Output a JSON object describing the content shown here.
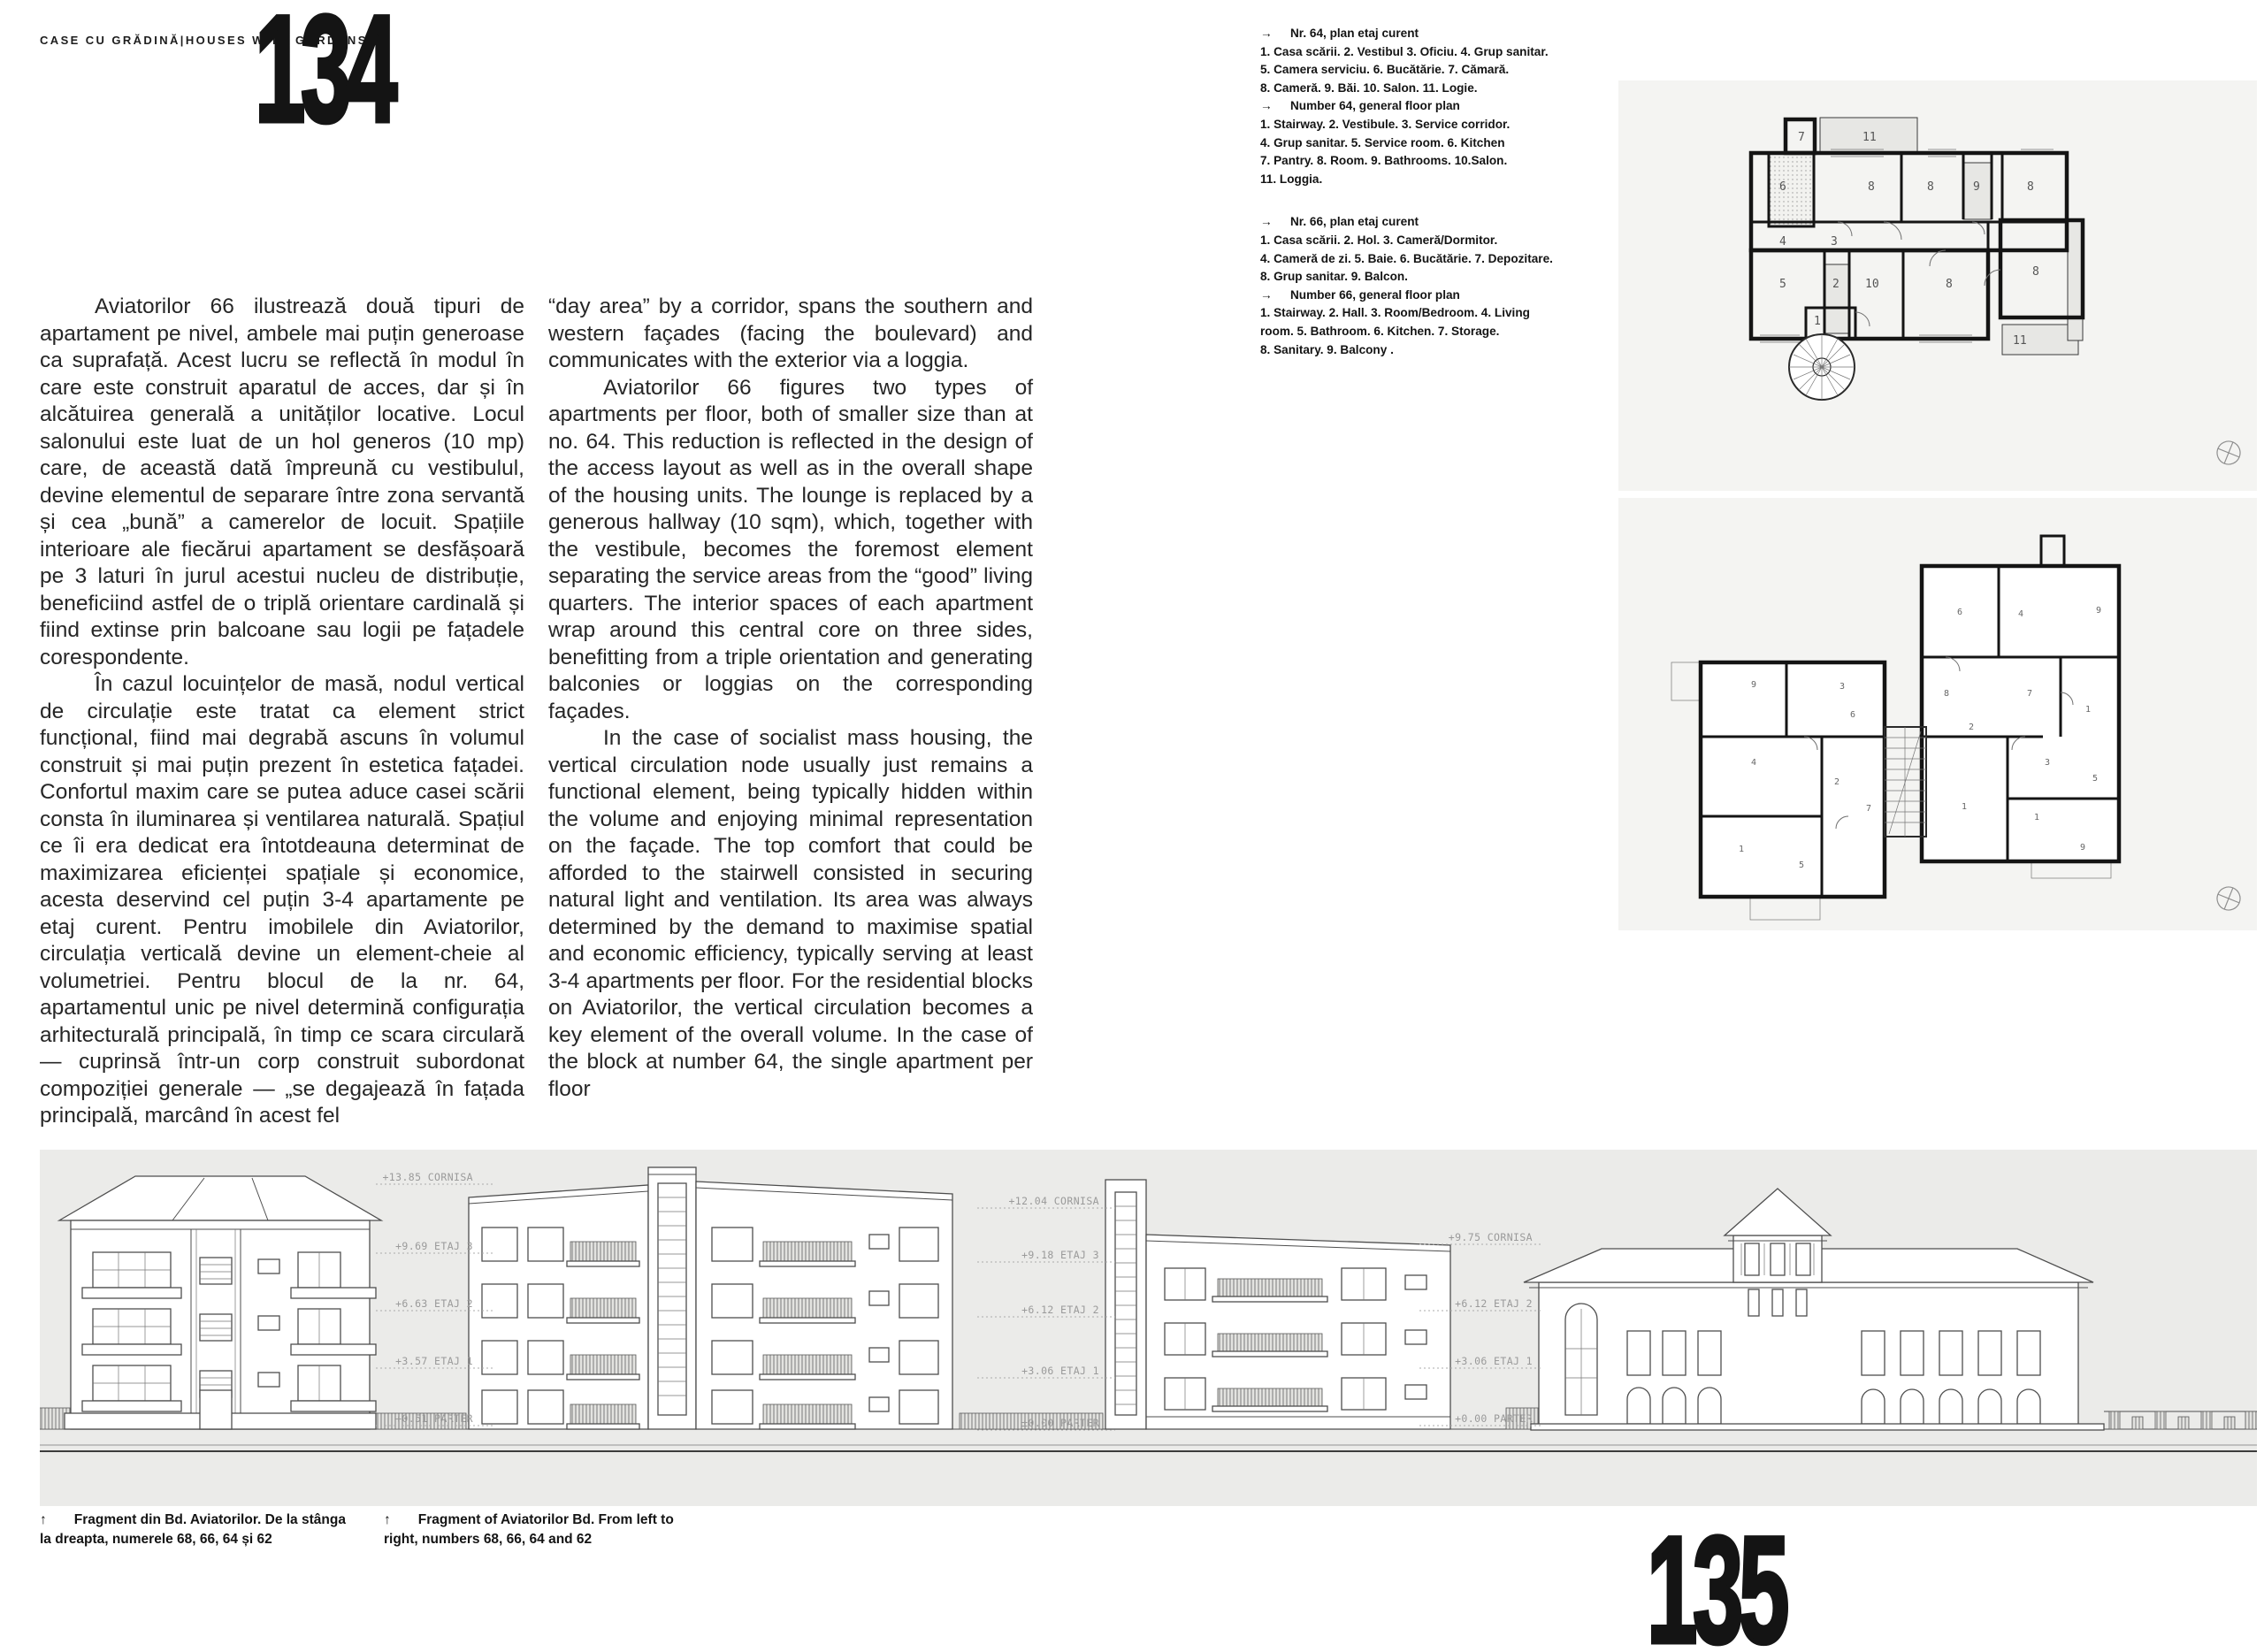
{
  "header": {
    "title": "CASE CU GRĂDINĂ|HOUSES WITH GARDENS"
  },
  "page_numbers": {
    "left": "134",
    "right": "135"
  },
  "colors": {
    "page_bg": "#ffffff",
    "panel_bg": "#f4f4f2",
    "elevation_bg": "#ebebe9",
    "ink": "#232323",
    "drawing_line": "#4e4e4e",
    "level_label": "#9a9a9a"
  },
  "article": {
    "col_ro": [
      {
        "cls": "indent",
        "text": "Aviatorilor 66 ilustrează două tipuri de apartament pe nivel, ambele mai puțin generoase ca suprafață. Acest lucru se reflectă în modul în care este construit aparatul de acces, dar și în alcătuirea generală a unităților locative. Locul salonului este luat de un hol generos (10 mp) care, de această dată împreună cu vestibulul, devine elementul de separare între zona servantă și cea „bună” a camerelor de locuit. Spațiile interioare ale fiecărui apartament se desfășoară pe 3 laturi în jurul acestui nucleu de distribuție, beneficiind astfel de o triplă orientare cardinală și fiind extinse prin balcoane sau logii pe fațadele corespondente."
      },
      {
        "cls": "indent",
        "text": "În cazul locuințelor de masă, nodul vertical de circulație este tratat ca element strict funcțional, fiind mai degrabă ascuns în volumul construit și mai puțin prezent în estetica fațadei. Confortul maxim care se putea aduce casei scării consta în iluminarea și ventilarea naturală. Spațiul ce îi era dedicat era întotdeauna determinat de maximizarea eficienței spațiale și economice, acesta deservind cel puțin 3-4 apartamente pe etaj curent. Pentru imobilele din Aviatorilor, circulația verticală devine un element-cheie al volumetriei. Pentru blocul de la nr. 64, apartamentul unic pe nivel determină configurația arhitecturală principală, în timp ce scara circulară — cuprinsă într-un corp construit subordonat compoziției generale — „se degajează în fațada principală, marcând în acest fel"
      }
    ],
    "col_en": [
      {
        "cls": "",
        "text": "“day area” by a corridor, spans the southern and western façades (facing the boulevard) and communicates with the exterior via a loggia."
      },
      {
        "cls": "indent",
        "text": "Aviatorilor 66 figures two types of apartments per floor, both of smaller size than at no. 64. This reduction is reflected in the design of the access layout as well as in the overall shape of the housing units. The lounge is replaced by a generous hallway (10 sqm), which, together with the vestibule, becomes the foremost element separating the service areas from the “good” living quarters. The interior spaces of each apartment wrap around this central core on three sides, benefitting from a triple orientation and generating balconies or loggias on the corresponding façades."
      },
      {
        "cls": "indent",
        "text": "In the case of socialist mass housing, the vertical circulation node usually just remains a functional element, being typically hidden within the volume and enjoying minimal representation on the façade. The top comfort that could be afforded to the stairwell consisted in securing natural light and ventilation. Its area was always determined by the demand to maximise spatial and economic efficiency, typically serving at least 3-4 apartments per floor. For the residential blocks on Aviatorilor, the vertical circulation becomes a key element of the overall volume. In the case of the block at number 64, the single apartment per floor"
      }
    ]
  },
  "captions": {
    "plan64_lines": [
      "→  Nr. 64, plan etaj curent",
      "1. Casa scării. 2. Vestibul 3. Oficiu. 4. Grup sanitar.",
      "5. Camera serviciu. 6. Bucătărie. 7. Cămară.",
      "8. Cameră. 9. Băi. 10. Salon. 11. Logie.",
      "→  Number 64, general floor plan",
      "1. Stairway. 2. Vestibule. 3. Service corridor.",
      "4. Grup sanitar. 5. Service room. 6. Kitchen",
      "7. Pantry. 8. Room. 9. Bathrooms. 10.Salon.",
      "11. Loggia."
    ],
    "plan66_lines": [
      "→  Nr. 66, plan etaj curent",
      "1. Casa scării. 2. Hol. 3. Cameră/Dormitor.",
      "4. Cameră de zi. 5. Baie. 6. Bucătărie. 7. Depozitare.",
      "8. Grup sanitar. 9. Balcon.",
      "→  Number 66, general floor plan",
      "1. Stairway. 2. Hall. 3. Room/Bedroom. 4. Living",
      "room. 5. Bathroom. 6. Kitchen. 7. Storage.",
      "8. Sanitary. 9. Balcony ."
    ]
  },
  "figure_captions": {
    "left_lines": [
      "↑  Fragment din Bd. Aviatorilor. De la stânga",
      "la dreapta, numerele 68, 66, 64 și 62"
    ],
    "right_lines": [
      "↑  Fragment of Aviatorilor Bd. From left to",
      "right, numbers 68, 66, 64 and 62"
    ]
  },
  "elevation": {
    "levels_66": [
      "+13.85 CORNISA",
      "+9.69 ETAJ 3",
      "+6.63 ETAJ 2",
      "+3.57 ETAJ 1",
      "+0.51 PARTER"
    ],
    "levels_64": [
      "+12.04 CORNISA",
      "+9.18 ETAJ 3",
      "+6.12 ETAJ 2",
      "+3.06 ETAJ 1",
      "±0.00 PARTER"
    ],
    "levels_62": [
      "+9.75 CORNISA",
      "+6.12 ETAJ 2",
      "+3.06 ETAJ 1",
      "+0.00 PARTER"
    ]
  },
  "plans": {
    "plan64_rooms": [
      "7",
      "11",
      "6",
      "8",
      "8",
      "9",
      "8",
      "4",
      "3",
      "5",
      "2",
      "10",
      "8",
      "8",
      "1",
      "11"
    ],
    "plan66_rooms": [
      "6",
      "4",
      "9",
      "8",
      "7",
      "1",
      "2",
      "3",
      "1",
      "1",
      "5",
      "9",
      "9",
      "3",
      "4",
      "6",
      "2",
      "7",
      "1",
      "5"
    ]
  }
}
